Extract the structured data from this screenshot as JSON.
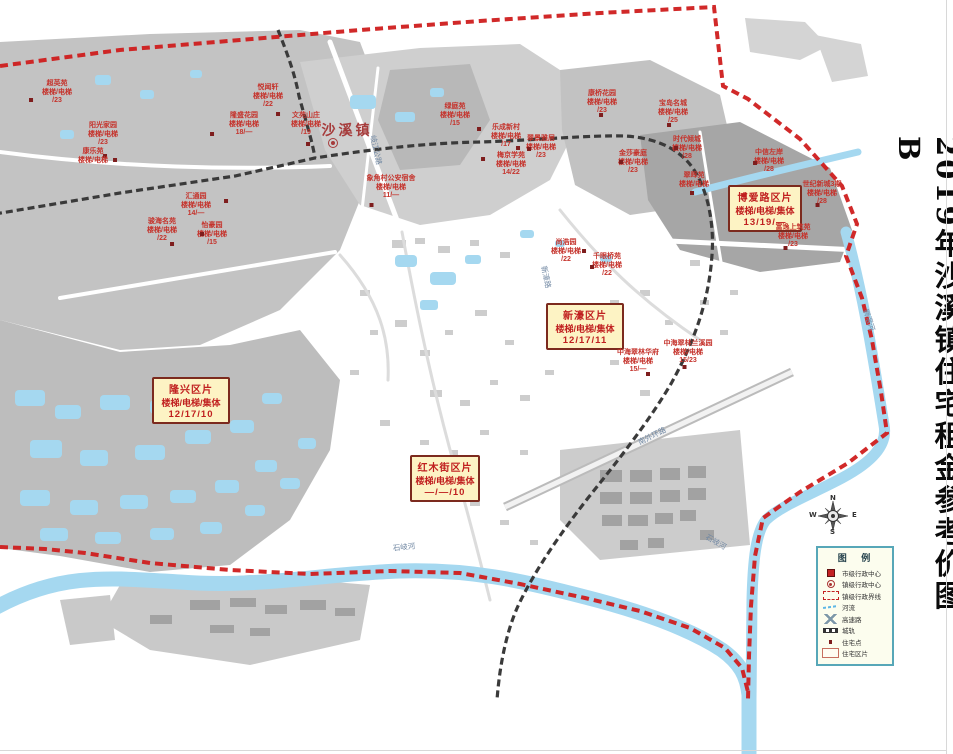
{
  "title": "2019年沙溪镇住宅租金参考价图B",
  "town": {
    "name": "沙溪镇"
  },
  "colors": {
    "boundary": "#cf1d1d",
    "water": "#a5d8f0",
    "district_box_bg": "#fdf3c4",
    "district_box_border": "#7c2a1e",
    "label_red": "#c5332c",
    "legend_border": "#57a7b8"
  },
  "districts": [
    {
      "name": "隆兴区片",
      "line2": "楼梯/电梯/集体",
      "line3": "12/17/10",
      "x": 152,
      "y": 377,
      "w": 78
    },
    {
      "name": "红木街区片",
      "line2": "楼梯/电梯/集体",
      "line3": "—/—/10",
      "x": 410,
      "y": 455,
      "w": 70
    },
    {
      "name": "新濠区片",
      "line2": "楼梯/电梯/集体",
      "line3": "12/17/11",
      "x": 546,
      "y": 303,
      "w": 78
    },
    {
      "name": "博爱路区片",
      "line2": "楼梯/电梯/集体",
      "line3": "13/19/—",
      "x": 728,
      "y": 185,
      "w": 74
    }
  ],
  "sites": [
    {
      "name": "超英苑",
      "sub": "楼梯/电梯",
      "value": "/23",
      "x": 57,
      "y": 80,
      "dot": [
        -28,
        18
      ]
    },
    {
      "name": "阳光家园",
      "sub": "楼梯/电梯",
      "value": "/23",
      "x": 103,
      "y": 122,
      "dot": [
        0,
        32
      ]
    },
    {
      "name": "悦闻轩",
      "sub": "楼梯/电梯",
      "value": "/22",
      "x": 268,
      "y": 84,
      "dot": [
        8,
        28
      ]
    },
    {
      "name": "隆盛花园",
      "sub": "楼梯/电梯",
      "value": "18/—",
      "x": 244,
      "y": 112,
      "dot": [
        -34,
        20
      ]
    },
    {
      "name": "文苑山庄",
      "sub": "楼梯/电梯",
      "value": "/19",
      "x": 306,
      "y": 112,
      "dot": [
        0,
        30
      ]
    },
    {
      "name": "康乐苑",
      "sub": "楼梯/电梯",
      "value": "",
      "x": 93,
      "y": 148,
      "dot": [
        20,
        10
      ]
    },
    {
      "name": "汇通园",
      "sub": "楼梯/电梯",
      "value": "14/—",
      "x": 196,
      "y": 193,
      "dot": [
        28,
        6
      ]
    },
    {
      "name": "骏海名苑",
      "sub": "楼梯/电梯",
      "value": "/22",
      "x": 162,
      "y": 218,
      "dot": [
        8,
        24
      ]
    },
    {
      "name": "怡豪园",
      "sub": "楼梯/电梯",
      "value": "/15",
      "x": 212,
      "y": 222,
      "dot": [
        -12,
        10
      ]
    },
    {
      "name": "象角村公安宿舍",
      "sub": "楼梯/电梯",
      "value": "11/—",
      "x": 391,
      "y": 175,
      "dot": [
        -22,
        28
      ]
    },
    {
      "name": "绿庭苑",
      "sub": "楼梯/电梯",
      "value": "/15",
      "x": 455,
      "y": 103,
      "dot": [
        22,
        24
      ]
    },
    {
      "name": "乐成新村",
      "sub": "楼梯/电梯",
      "value": "/17",
      "x": 506,
      "y": 124,
      "dot": [
        10,
        22
      ]
    },
    {
      "name": "翠景雅居",
      "sub": "楼梯/电梯",
      "value": "/23",
      "x": 541,
      "y": 135,
      "dot": [
        -14,
        12
      ]
    },
    {
      "name": "梅京学苑",
      "sub": "楼梯/电梯",
      "value": "14/22",
      "x": 511,
      "y": 152,
      "dot": [
        -30,
        5
      ]
    },
    {
      "name": "康桥花园",
      "sub": "楼梯/电梯",
      "value": "/23",
      "x": 602,
      "y": 90,
      "dot": [
        -3,
        23
      ]
    },
    {
      "name": "宝岛名城",
      "sub": "楼梯/电梯",
      "value": "/25",
      "x": 673,
      "y": 100,
      "dot": [
        -6,
        23
      ]
    },
    {
      "name": "时代倾城",
      "sub": "楼梯/电梯",
      "value": "/28",
      "x": 687,
      "y": 136,
      "dot": [
        -13,
        10
      ]
    },
    {
      "name": "金莎豪庭",
      "sub": "楼梯/电梯",
      "value": "/23",
      "x": 633,
      "y": 150,
      "dot": [
        -14,
        10
      ]
    },
    {
      "name": "翠晖苑",
      "sub": "楼梯/电梯",
      "value": "",
      "x": 694,
      "y": 172,
      "dot": [
        -4,
        19
      ]
    },
    {
      "name": "中信左岸",
      "sub": "楼梯/电梯",
      "value": "/28",
      "x": 769,
      "y": 149,
      "dot": [
        -16,
        12
      ]
    },
    {
      "name": "世纪新城3期",
      "sub": "楼梯/电梯",
      "value": "/28",
      "x": 822,
      "y": 181,
      "dot": [
        -6,
        22
      ]
    },
    {
      "name": "富逸上筑苑",
      "sub": "楼梯/电梯",
      "value": "/23",
      "x": 793,
      "y": 224,
      "dot": [
        -10,
        22
      ]
    },
    {
      "name": "尚浩园",
      "sub": "楼梯/电梯",
      "value": "/22",
      "x": 566,
      "y": 239,
      "dot": [
        16,
        10
      ]
    },
    {
      "name": "千眼桥苑",
      "sub": "楼梯/电梯",
      "value": "/22",
      "x": 607,
      "y": 253,
      "dot": [
        -17,
        12
      ]
    },
    {
      "name": "中海翠林华府",
      "sub": "楼梯/电梯",
      "value": "15/—",
      "x": 638,
      "y": 349,
      "dot": [
        8,
        23
      ]
    },
    {
      "name": "中海翠林兰溪园",
      "sub": "楼梯/电梯",
      "value": "15/23",
      "x": 688,
      "y": 340,
      "dot": [
        -6,
        25
      ]
    }
  ],
  "road_labels": [
    {
      "text": "岐江公路",
      "x": 376,
      "y": 150,
      "rot": 78
    },
    {
      "text": "新濠路",
      "x": 546,
      "y": 277,
      "rot": 78
    },
    {
      "text": "南外环路",
      "x": 652,
      "y": 436,
      "rot": -27
    },
    {
      "text": "石岐河",
      "x": 404,
      "y": 547,
      "rot": -6
    },
    {
      "text": "石岐河",
      "x": 716,
      "y": 542,
      "rot": 30
    },
    {
      "text": "狮滘河",
      "x": 869,
      "y": 320,
      "rot": 72
    }
  ],
  "legend": {
    "title": "图 例",
    "items": [
      {
        "sym": "city",
        "label": "市级行政中心"
      },
      {
        "sym": "town",
        "label": "镇级行政中心"
      },
      {
        "sym": "boundary",
        "label": "镇级行政界线"
      },
      {
        "sym": "river",
        "label": "河流"
      },
      {
        "sym": "highway",
        "label": "高速路"
      },
      {
        "sym": "rail",
        "label": "城轨"
      },
      {
        "sym": "point",
        "label": "住宅点"
      },
      {
        "sym": "zone",
        "label": "住宅区片"
      }
    ]
  },
  "compass": {
    "n": "N",
    "s": "S",
    "e": "E",
    "w": "W"
  }
}
